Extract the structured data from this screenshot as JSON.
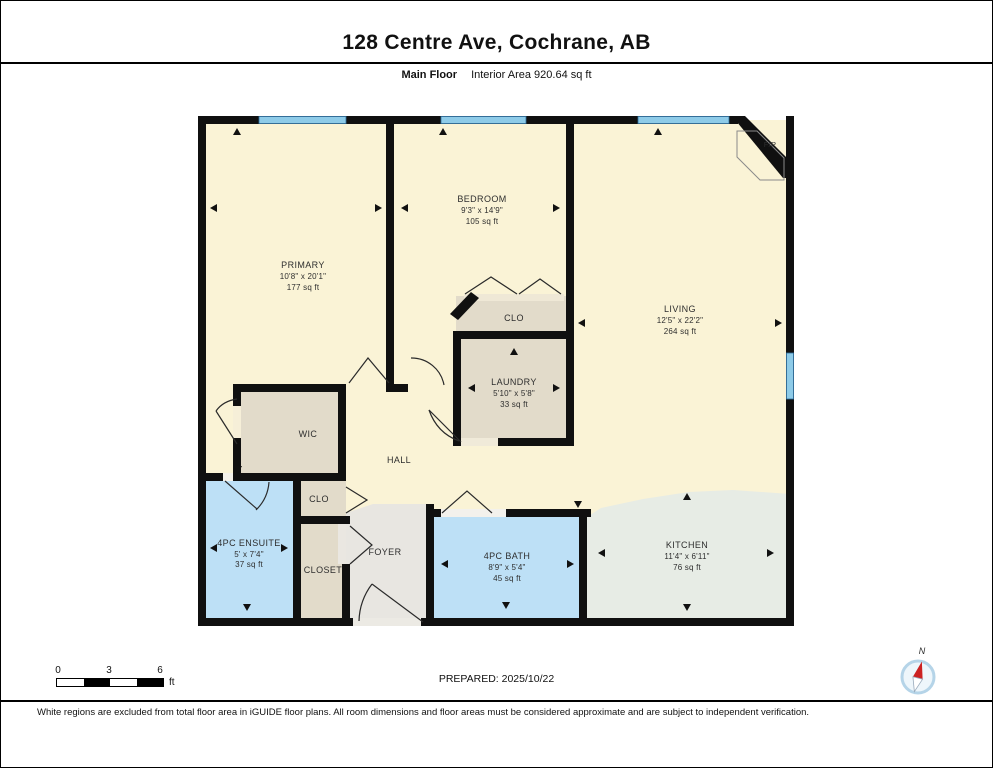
{
  "header": {
    "title": "128 Centre Ave, Cochrane, AB",
    "floor_label": "Main Floor",
    "area_label": "Interior Area 920.64 sq ft"
  },
  "rooms": {
    "primary": {
      "name": "PRIMARY",
      "dims": "10'8\" x 20'1\"",
      "area": "177 sq ft"
    },
    "bedroom": {
      "name": "BEDROOM",
      "dims": "9'3\" x 14'9\"",
      "area": "105 sq ft"
    },
    "living": {
      "name": "LIVING",
      "dims": "12'5\" x 22'2\"",
      "area": "264 sq ft"
    },
    "laundry": {
      "name": "LAUNDRY",
      "dims": "5'10\" x 5'8\"",
      "area": "33 sq ft"
    },
    "kitchen": {
      "name": "KITCHEN",
      "dims": "11'4\" x 6'11\"",
      "area": "76 sq ft"
    },
    "ensuite": {
      "name": "4PC ENSUITE",
      "dims": "5' x 7'4\"",
      "area": "37 sq ft"
    },
    "bath": {
      "name": "4PC BATH",
      "dims": "8'9\" x 5'4\"",
      "area": "45 sq ft"
    },
    "wic": {
      "name": "WIC"
    },
    "hall": {
      "name": "HALL"
    },
    "clo_bedroom": {
      "name": "CLO"
    },
    "clo_hall": {
      "name": "CLO"
    },
    "closet": {
      "name": "CLOSET"
    },
    "foyer": {
      "name": "FOYER"
    },
    "fireplace": {
      "name": "F/P"
    }
  },
  "scale": {
    "tick0": "0",
    "tick1": "3",
    "tick2": "6",
    "unit": "ft"
  },
  "compass": {
    "north_label": "N"
  },
  "footer": {
    "prepared": "PREPARED: 2025/10/22",
    "disclaimer": "White regions are excluded from total floor area in iGUIDE floor plans. All room dimensions and floor areas must be considered approximate and are subject to independent verification."
  },
  "colors": {
    "room_cream": "#faf3d6",
    "room_beige": "#e2dbca",
    "room_blue": "#bde0f6",
    "room_gray": "#e8e6e1",
    "room_kitchen": "#e7ece5",
    "window_blue": "#8ecbe8",
    "wall_black": "#101010"
  }
}
